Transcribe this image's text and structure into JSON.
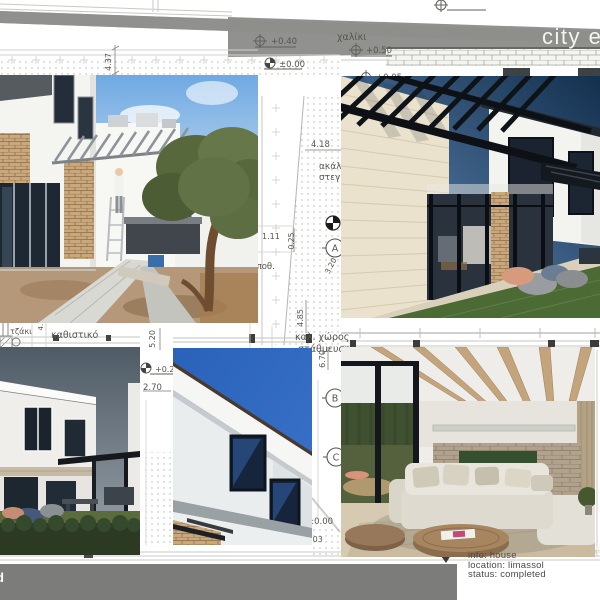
{
  "banner": {
    "title": "city e",
    "bg_color": "#8d8d8b",
    "text_color": "#f4f4f2"
  },
  "info_panel": {
    "lines": [
      "info: house",
      "location: limassol",
      "status: completed"
    ]
  },
  "bottom_bar": {
    "fragment": "d",
    "bg_color": "#7c7c7a"
  },
  "drawing": {
    "labels": [
      "4.37",
      "+0.40",
      "χαλίκι",
      "+0.50",
      "±0.00",
      "+0.05",
      "4.18",
      "ακάλυπτος",
      "στεγασμένο",
      "1.11",
      "0.25",
      "αποθ.",
      "3.20",
      "4.85",
      "καλ. χώρος",
      "στάθμευσης",
      "τζάκι",
      "καθιστικό",
      "4.1",
      "5.20",
      "2.70",
      "+0.20",
      "±0.00",
      "1.03",
      "6.70"
    ],
    "section_markers": {
      "a": "A",
      "b": "B",
      "c": "C"
    }
  },
  "photos": {
    "top_left": "courtyard-construction-photo",
    "top_right": "exterior-render",
    "bottom_left": "dusk-exterior-render",
    "bottom_middle": "facade-corner-photo",
    "bottom_right": "living-room-render"
  }
}
